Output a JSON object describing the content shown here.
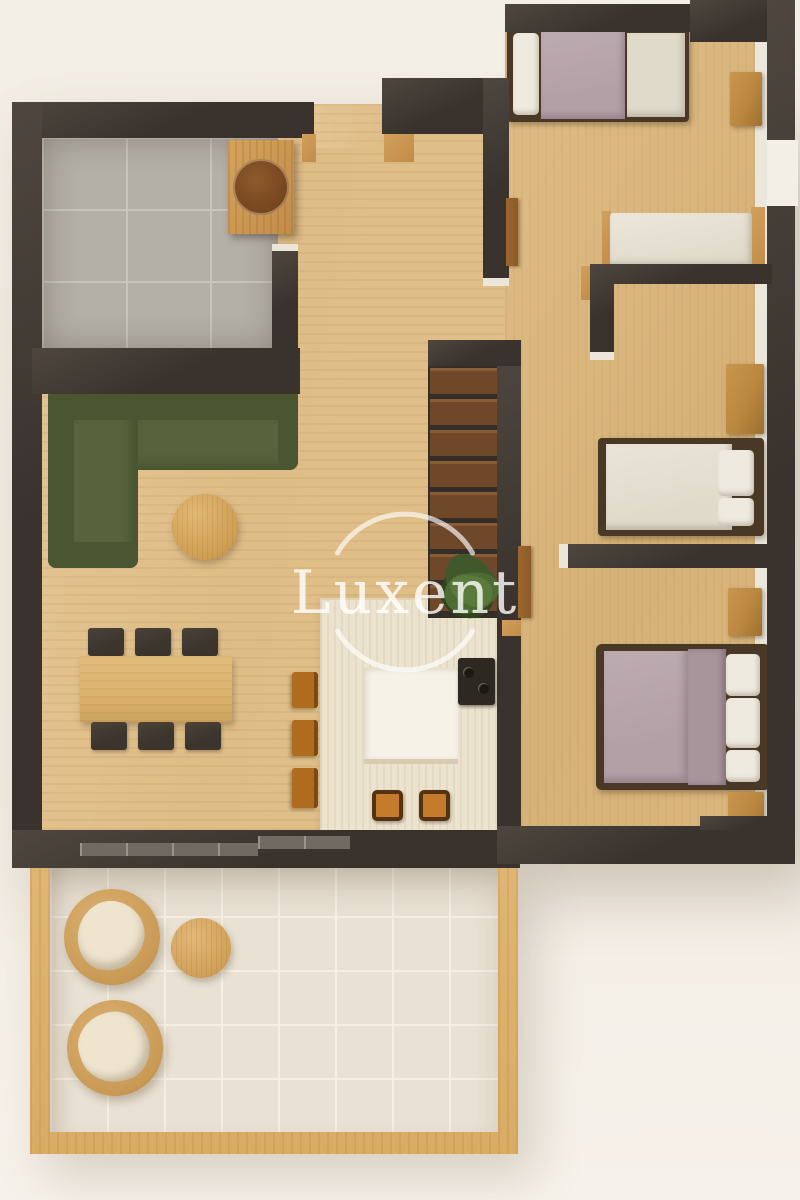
{
  "watermark": {
    "text": "Luxent"
  },
  "scene_label": "apartment-floor-plan-top-view",
  "colors": {
    "bg": "#f3eee6",
    "wall": "#3a332d",
    "wallHi": "#4e463f",
    "wood": "#dfbd87",
    "woodDeep": "#d6b278",
    "capWood": "#c18c48",
    "capLight": "#ece6da",
    "glass": "#716a62",
    "bathTile": "#b4afa7",
    "bathGrout": "#c9c4bc",
    "counter": "#ece3cf",
    "counterInner": "#f6f2e8",
    "cooktop": "#2e2822",
    "stool": "#c47c2c",
    "barChair": "#b06c1e",
    "sofa": "#57633c",
    "sofaDark": "#4a5531",
    "tableWood": "#dcb26e",
    "chairDark": "#3b352e",
    "tread": "#6f482a",
    "treadHi": "#8a5c36",
    "stairWell": "#352e28",
    "plant": "#41582c",
    "plantDark": "#2f441f",
    "door": "#8d5b28",
    "bedFrame": "#4a3827",
    "mauve": "#b2a0a6",
    "mauveDeep": "#a8959c",
    "whiteBed": "#e0dacb",
    "pillow": "#efeadf",
    "nightstand": "#b9873f",
    "terrTile": "#e9e1d3",
    "terrGrout": "#f4eee3",
    "frameWood": "#d9ac64",
    "wicker": "#c99a55",
    "wickerEdge": "#b3813f",
    "cushion": "#efe5cf",
    "stripLight": "#ece7dc"
  }
}
